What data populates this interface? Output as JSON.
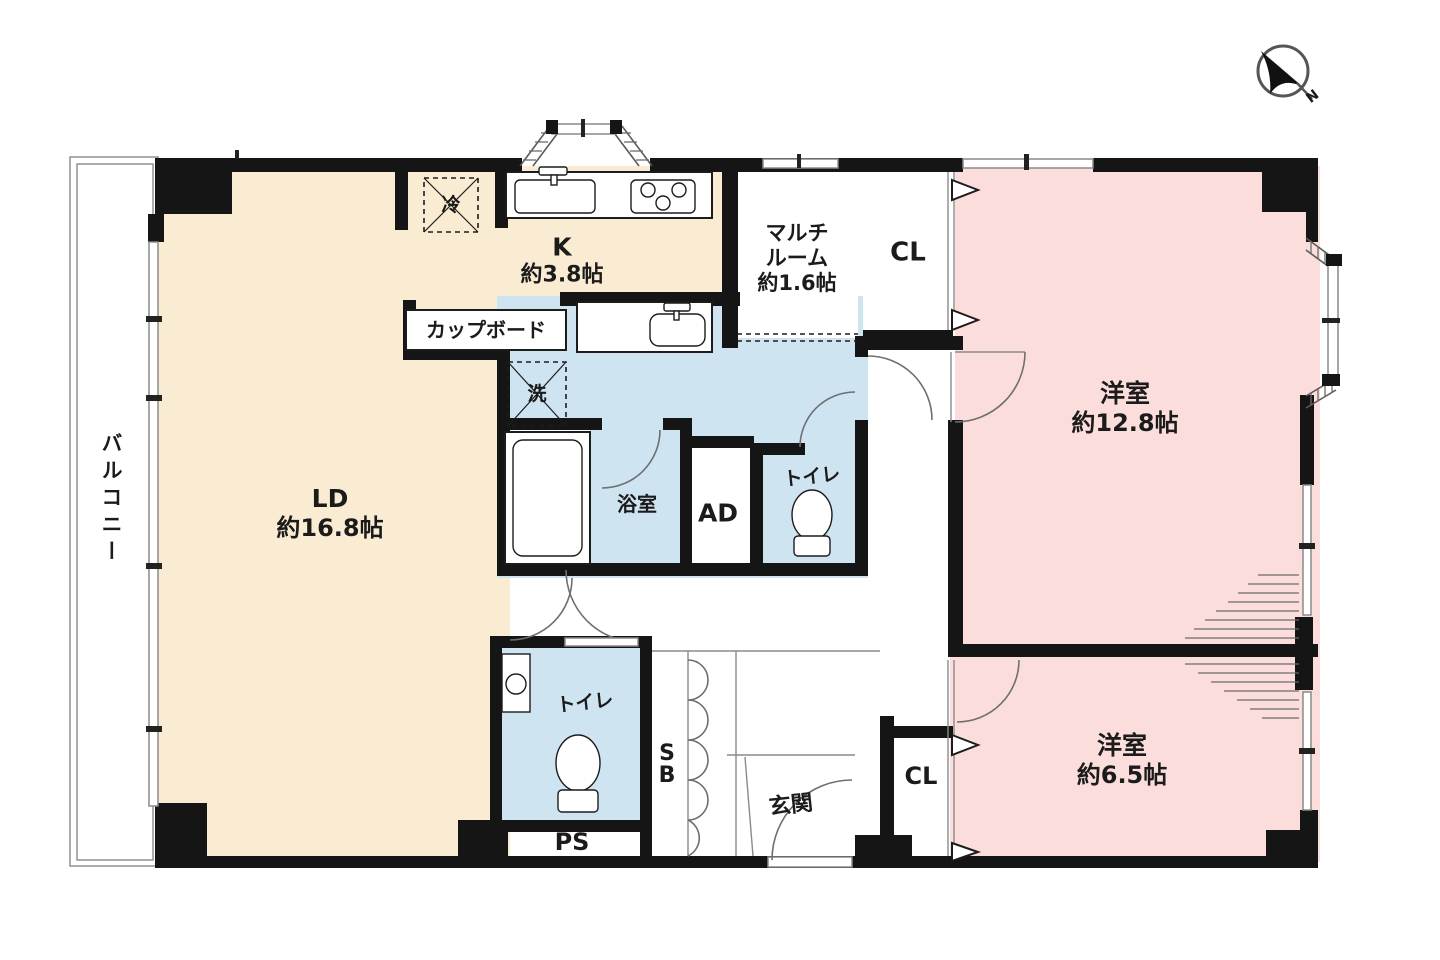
{
  "title": "apartment-floor-plan",
  "colors": {
    "floor_beige": "#faecd2",
    "floor_pink": "#fbdedb",
    "floor_blue": "#cfe4f1",
    "wall": "#151515",
    "window_line": "#8a8a8a",
    "hatch": "#6b6b6b"
  },
  "labels": {
    "balcony": "バルコニー",
    "ld_name": "LD",
    "ld_size": "約16.8帖",
    "k_name": "K",
    "k_size": "約3.8帖",
    "cupboard": "カップボード",
    "fridge": "冷",
    "laundry": "洗",
    "bath": "浴室",
    "ad": "AD",
    "toilet_upper": "トイレ",
    "toilet_lower": "トイレ",
    "multi_line1": "マルチ",
    "multi_line2": "ルーム",
    "multi_size": "約1.6帖",
    "cl_top": "CL",
    "cl_bottom": "CL",
    "west_room1_name": "洋室",
    "west_room1_size": "約12.8帖",
    "west_room2_name": "洋室",
    "west_room2_size": "約6.5帖",
    "sb_line1": "S",
    "sb_line2": "B",
    "genkan": "玄関",
    "ps": "PS"
  },
  "compass": {
    "north_label": "N"
  }
}
